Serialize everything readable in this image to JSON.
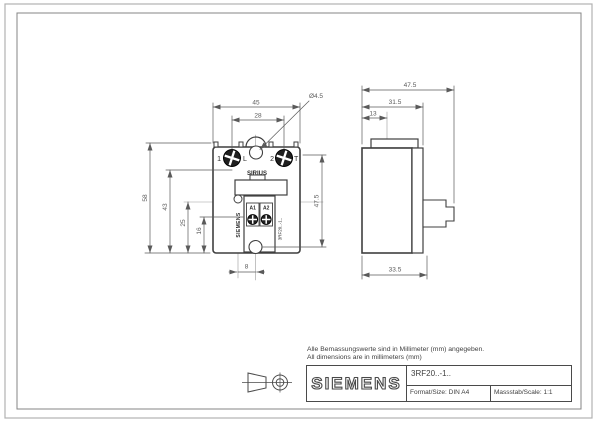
{
  "notes": {
    "line1": "Alle Bemassungswerte sind in Millimeter (mm) angegeben.",
    "line2": "All dimensions are in millimeters (mm)"
  },
  "title_block": {
    "brand": "SIEMENS",
    "part_number": "3RF20..-1..",
    "format": "Format/Size: DIN A4",
    "scale": "Massstab/Scale: 1:1"
  },
  "front_view": {
    "dims": {
      "overall_width": "45",
      "terminal_spacing": "28",
      "hole_diameter": "Ø4.5",
      "overall_height": "58",
      "dim_43": "43",
      "dim_25": "25",
      "dim_16": "16",
      "hole_spacing_vertical": "47.5",
      "led_offset": "8"
    },
    "labels": {
      "terminal_1": "1",
      "terminal_1_tag": "L",
      "terminal_2": "2",
      "terminal_2_tag": "T",
      "product_line": "SIRIUS",
      "brand_vertical": "SIEMENS",
      "part_vertical": "3RF20..-1..",
      "control_a1": "A1",
      "control_a2": "A2"
    }
  },
  "side_view": {
    "dims": {
      "overall_depth": "47.5",
      "body_depth": "31.5",
      "hole_axis_depth": "13",
      "base_depth": "33.5"
    }
  },
  "colors": {
    "line": "#3f3f3f",
    "dim": "#5a5a5a",
    "page_border_outer": "#b2b2b2",
    "page_border_inner": "#848484"
  }
}
